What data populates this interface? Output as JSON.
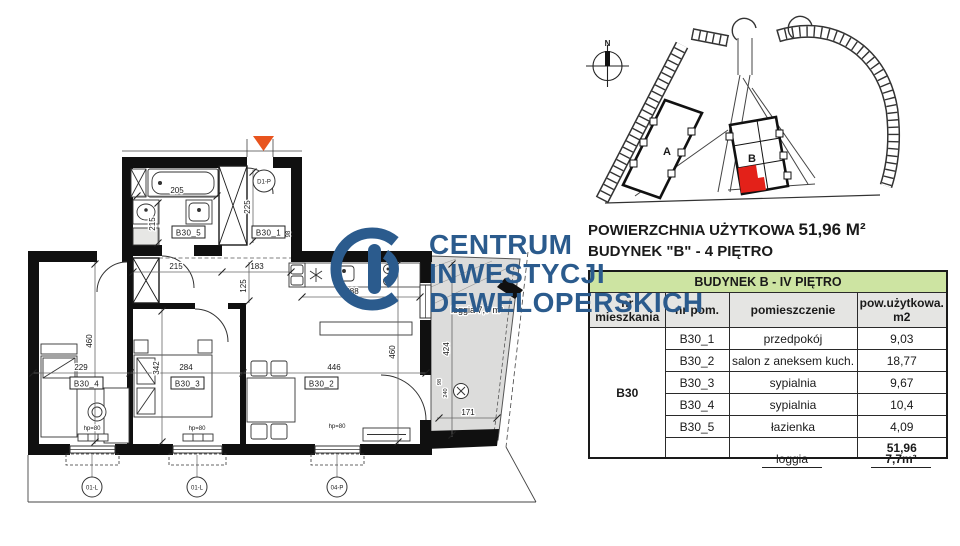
{
  "colors": {
    "accent_blue": "#2b5b8d",
    "table_title_green": "#cde4a2",
    "table_header_gray": "#e5e5e3",
    "highlight_red": "#e32119",
    "entry_marker_orange": "#e8541e",
    "loggia_fill_gray": "#dcdcdb"
  },
  "watermark": {
    "line1": "CENTRUM",
    "line2": "INWESTYCJI",
    "line3": "DEWELOPERSKICH"
  },
  "summary": {
    "area_label": "POWIERZCHNIA UŻYTKOWA",
    "area_value": "51,96 M²",
    "building_line": "BUDYNEK \"B\" - 4 PIĘTRO"
  },
  "site_plan": {
    "north": "N",
    "building_a": "A",
    "building_b": "B"
  },
  "table": {
    "title": "BUDYNEK B - IV PIĘTRO",
    "col_apartment": "nr mieszkania",
    "col_room": "nr pom.",
    "col_name": "pomieszczenie",
    "col_area": "pow.użytkowa.\nm2",
    "apartment": "B30",
    "rows": [
      {
        "nr": "B30_1",
        "name": "przedpokój",
        "area": "9,03"
      },
      {
        "nr": "B30_2",
        "name": "salon z aneksem kuch.",
        "area": "18,77"
      },
      {
        "nr": "B30_3",
        "name": "sypialnia",
        "area": "9,67"
      },
      {
        "nr": "B30_4",
        "name": "sypialnia",
        "area": "10,4"
      },
      {
        "nr": "B30_5",
        "name": "łazienka",
        "area": "4,09"
      }
    ],
    "total": "51,96",
    "loggia_label": "loggia",
    "loggia_value": "7,7m²"
  },
  "floor_plan": {
    "rooms": {
      "hall": "B30_1",
      "living": "B30_2",
      "bedroom_a": "B30_3",
      "bedroom_b": "B30_4",
      "bathroom": "B30_5"
    },
    "loggia_text": "loggia 7,7 m²",
    "dims": {
      "bath_w": "205",
      "bath_d": "215",
      "hall_d": "225",
      "hall_w": "98",
      "corr_a": "215",
      "corr_b": "183",
      "corr_w": "125",
      "bed4_w": "229",
      "bed4_d": "460",
      "bed3_w": "284",
      "bed3_d": "342",
      "living_w": "446",
      "living_d": "460",
      "kitchen_w": "288",
      "loggia_d": "424",
      "loggia_w": "171",
      "loggia_door_w": "98",
      "loggia_door_h": "240"
    },
    "sill": "hp=80",
    "window_tags": [
      "01-L",
      "01-L",
      "04-P"
    ],
    "entry_tag": "D1-P"
  }
}
